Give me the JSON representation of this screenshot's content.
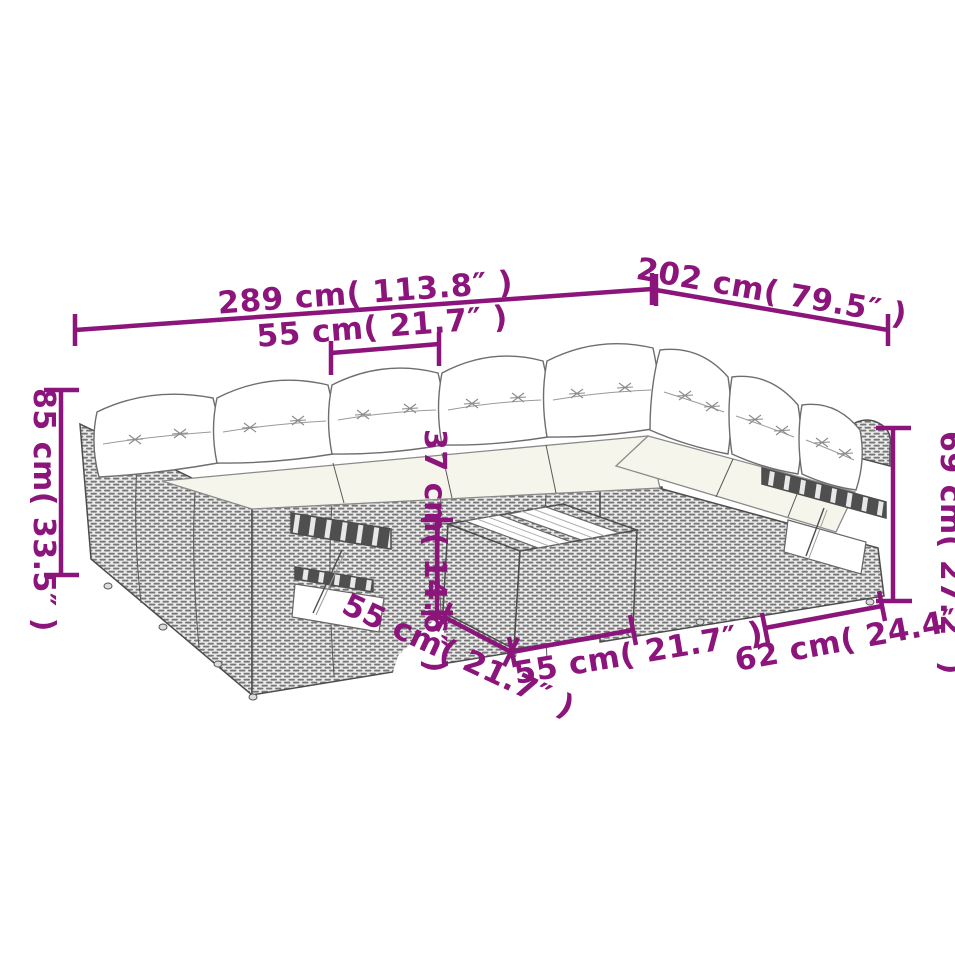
{
  "image": {
    "title": "Rattan garden corner sofa set — dimension diagram",
    "background_color": "#ffffff",
    "annotation_color": "#8b157b",
    "line_art_color": "#4d4d4d"
  },
  "dimensions": {
    "overall_width": {
      "cm": "289",
      "in": "113.8",
      "label": "289 cm( 113.8″ )"
    },
    "overall_depth": {
      "cm": "202",
      "in": "79.5",
      "label": "202 cm( 79.5″ )"
    },
    "seat_width": {
      "cm": "55",
      "in": "21.7",
      "label": "55 cm( 21.7″ )"
    },
    "back_height": {
      "cm": "85",
      "in": "33.5",
      "label": "85 cm( 33.5″ )"
    },
    "arm_height": {
      "cm": "69",
      "in": "27.2",
      "label": "69 cm( 27.2″ )"
    },
    "table_height": {
      "cm": "37",
      "in": "14.6",
      "label": "37 cm( 14.6″ )"
    },
    "seat_depth": {
      "cm": "55",
      "in": "21.7",
      "label": "55 cm( 21.7″ )"
    },
    "table_width": {
      "cm": "55",
      "in": "21.7",
      "label": "55 cm( 21.7″ )"
    },
    "side_width": {
      "cm": "62",
      "in": "24.4",
      "label": "62 cm( 24.4″ )"
    }
  }
}
